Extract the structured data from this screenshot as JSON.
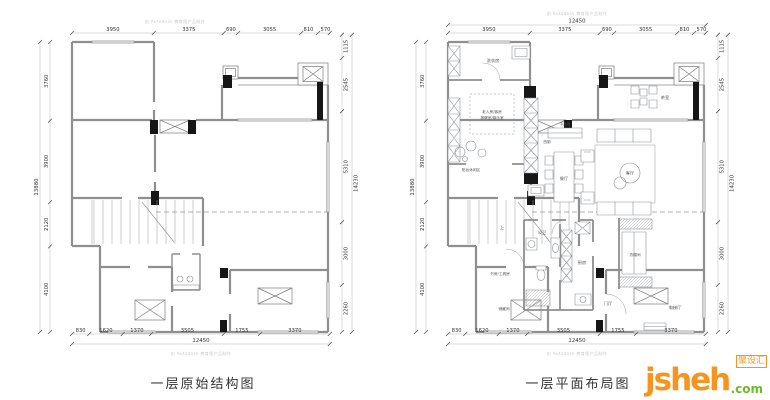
{
  "watermark": {
    "text": "由 Autodesk 教育版产品制作"
  },
  "dims": {
    "top": [
      "3950",
      "3375",
      "690",
      "3055",
      "810",
      "570"
    ],
    "top_total": "12450",
    "bottom": [
      "830",
      "1620",
      "1370",
      "3505",
      "1755",
      "3370"
    ],
    "bottom_total": "12450",
    "left": [
      "3760",
      "3900",
      "2120",
      "4100"
    ],
    "left_total": "13880",
    "right": [
      "1115",
      "2545",
      "5310",
      "3000",
      "2260"
    ],
    "right_total": "14230"
  },
  "plans": {
    "left": {
      "title": "一层原始结构图"
    },
    "right": {
      "title": "一层平面布局图"
    }
  },
  "rooms": {
    "laundry": "洗衣房",
    "guest_line1": "老人房/客房",
    "guest_line2": "棋牌室/娱乐室",
    "leisure": "阳台休闲区",
    "west_kitchen": "西厨",
    "island": "中岛台",
    "dining": "餐厅",
    "living": "客厅",
    "tea": "茶室",
    "study": "书房/工具房",
    "storage": "储藏间",
    "bath": "公卫",
    "kitchen": "厨房",
    "cloak": "衣帽间",
    "foyer": "门厅",
    "elevator": "电梯厅",
    "up": "上"
  },
  "logo": {
    "name": "jsheh",
    "tld": ".com",
    "badge": "聚设汇",
    "orange": "#f7941e",
    "green": "#6fb92c"
  }
}
